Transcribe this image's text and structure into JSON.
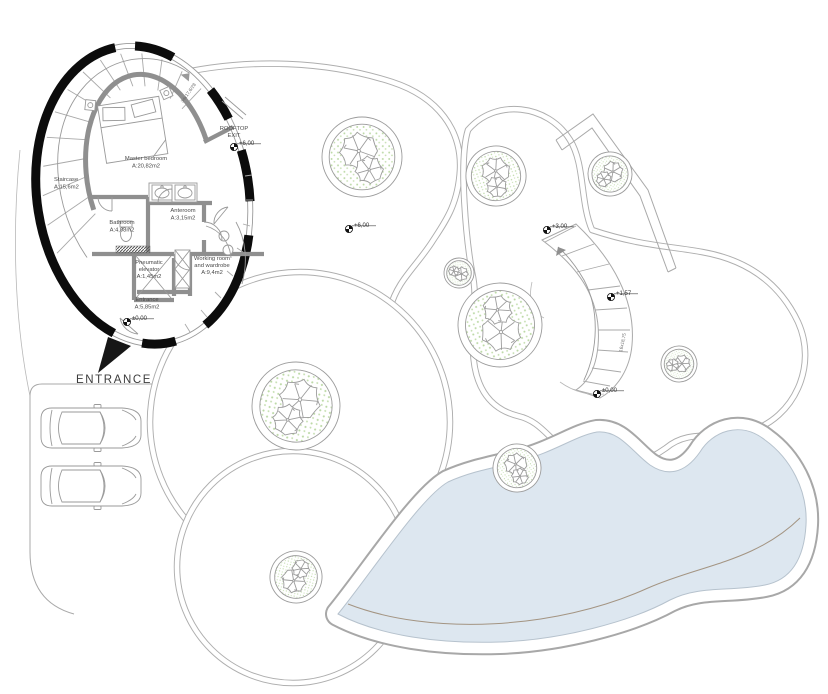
{
  "building": {
    "rooms": {
      "staircase": {
        "name": "Staircase",
        "area": "A:15,6m2"
      },
      "master_bedroom": {
        "name": "Master bedroom",
        "area": "A:20,82m2"
      },
      "bathroom": {
        "name": "Bathroom",
        "area": "A:4,08m2"
      },
      "anteroom": {
        "name": "Anteroom",
        "area": "A:3,15m2"
      },
      "elevator": {
        "name": "Pneumatic",
        "name2": "elevator",
        "area": "A:1,45m2"
      },
      "working_room": {
        "name": "Working room",
        "name2": "and wardrobe",
        "area": "A:9,4m2"
      },
      "entrance": {
        "name": "Entrance",
        "area": "A:5,85m2"
      }
    },
    "rooftop_exit_line1": "ROOFTOP",
    "rooftop_exit_line2": "EXIT",
    "stair_note": "34x17,6/28"
  },
  "site": {
    "entrance_label": "ENTRANCE",
    "outdoor_stair_note": "16x18,75",
    "levels": {
      "rooftop": "+6,00",
      "entrance": "±0,00",
      "upper_terrace": "+6,00",
      "mid_terrace": "+3,00",
      "stair_landing": "+1,57",
      "ground": "±0,00"
    }
  },
  "colors": {
    "pool_fill": "#dde7f0",
    "wall_black": "#0c0c0c",
    "wall_gray": "#8f8f8f",
    "line_gray": "#aeaeae",
    "tree_green": "#bcd9a6",
    "text": "#4a4a4a"
  }
}
